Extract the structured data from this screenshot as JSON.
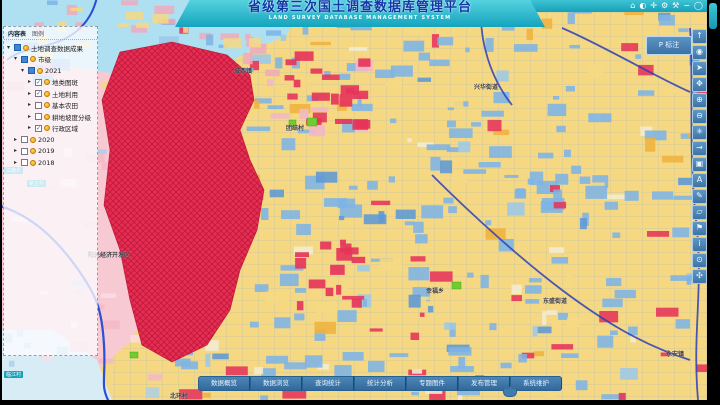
{
  "header": {
    "title": "省级第三次国土调查数据库管理平台",
    "subtitle": "LAND SURVEY DATABASE MANAGEMENT SYSTEM",
    "window_icons": [
      {
        "name": "home-icon",
        "glyph": "⌂"
      },
      {
        "name": "globe-icon",
        "glyph": "◐"
      },
      {
        "name": "locate-icon",
        "glyph": "✛"
      },
      {
        "name": "settings-gear-icon",
        "glyph": "⚙"
      },
      {
        "name": "tools-icon",
        "glyph": "⚒"
      },
      {
        "name": "minimize-icon",
        "glyph": "−"
      },
      {
        "name": "about-icon",
        "glyph": "◯"
      }
    ]
  },
  "annotate_button": {
    "label": "P 标注"
  },
  "layer_panel": {
    "tabs": [
      {
        "label": "内容表",
        "active": true
      },
      {
        "label": "图例",
        "active": false
      }
    ],
    "tree": [
      {
        "indent": 0,
        "expanded": true,
        "checkbox": null,
        "icons": [
          "bsq",
          "odot"
        ],
        "label": "土地调查数据成果"
      },
      {
        "indent": 1,
        "expanded": true,
        "checkbox": null,
        "icons": [
          "bsq",
          "odot"
        ],
        "label": "市级"
      },
      {
        "indent": 2,
        "expanded": true,
        "checkbox": null,
        "icons": [
          "bsq",
          "odot"
        ],
        "label": "2021"
      },
      {
        "indent": 3,
        "expanded": false,
        "checkbox": true,
        "icons": [
          "odot"
        ],
        "label": "地类图斑"
      },
      {
        "indent": 3,
        "expanded": false,
        "checkbox": true,
        "icons": [
          "odot"
        ],
        "label": "土地利用"
      },
      {
        "indent": 3,
        "expanded": false,
        "checkbox": false,
        "icons": [
          "odot"
        ],
        "label": "基本农田"
      },
      {
        "indent": 3,
        "expanded": false,
        "checkbox": false,
        "icons": [
          "odot"
        ],
        "label": "耕地坡度分级"
      },
      {
        "indent": 3,
        "expanded": false,
        "checkbox": true,
        "icons": [
          "odot"
        ],
        "label": "行政区域"
      },
      {
        "indent": 1,
        "expanded": false,
        "checkbox": false,
        "icons": [
          "odot"
        ],
        "label": "2020"
      },
      {
        "indent": 1,
        "expanded": false,
        "checkbox": false,
        "icons": [
          "odot"
        ],
        "label": "2019"
      },
      {
        "indent": 1,
        "expanded": false,
        "checkbox": false,
        "icons": [
          "odot"
        ],
        "label": "2018"
      }
    ]
  },
  "right_toolbar": {
    "buttons": [
      {
        "name": "pan-up-icon",
        "glyph": "↑"
      },
      {
        "name": "full-extent-icon",
        "glyph": "◉"
      },
      {
        "name": "select-cursor-icon",
        "glyph": "➤"
      },
      {
        "name": "pan-hand-icon",
        "glyph": "✥"
      },
      {
        "name": "zoom-in-icon",
        "glyph": "⊕"
      },
      {
        "name": "zoom-out-icon",
        "glyph": "⊖"
      },
      {
        "name": "previous-extent-icon",
        "glyph": "✳"
      },
      {
        "name": "next-extent-icon",
        "glyph": "→"
      },
      {
        "name": "identify-icon",
        "glyph": "▣"
      },
      {
        "name": "label-icon",
        "glyph": "A"
      },
      {
        "name": "sketch-pencil-icon",
        "glyph": "✎"
      },
      {
        "name": "edit-polygon-icon",
        "glyph": "▱"
      },
      {
        "name": "flag-icon",
        "glyph": "⚑"
      },
      {
        "name": "info-icon",
        "glyph": "i"
      },
      {
        "name": "query-icon",
        "glyph": "⊙"
      },
      {
        "name": "share-network-icon",
        "glyph": "✣"
      }
    ]
  },
  "bottom_toolbar": {
    "buttons": [
      {
        "label": "数据概览"
      },
      {
        "label": "数据浏览"
      },
      {
        "label": "查询统计"
      },
      {
        "label": "统计分析"
      },
      {
        "label": "专题图件"
      },
      {
        "label": "发布管理"
      },
      {
        "label": "系统维护"
      }
    ],
    "collapse_glyph": "ˇ"
  },
  "map": {
    "labels": [
      {
        "text": "城西镇",
        "x": 232,
        "y": 66,
        "style": "dark"
      },
      {
        "text": "兴华街道",
        "x": 472,
        "y": 82,
        "style": "dark"
      },
      {
        "text": "团结村",
        "x": 284,
        "y": 123,
        "style": "dark"
      },
      {
        "text": "阳光经济开发区",
        "x": 86,
        "y": 250,
        "style": "dark"
      },
      {
        "text": "幸福乡",
        "x": 424,
        "y": 286,
        "style": "dark"
      },
      {
        "text": "东盛街道",
        "x": 541,
        "y": 296,
        "style": "dark"
      },
      {
        "text": "永安镇",
        "x": 664,
        "y": 349,
        "style": "dark"
      },
      {
        "text": "北环村",
        "x": 168,
        "y": 391,
        "style": "dark"
      },
      {
        "text": "绕城高速",
        "x": 186,
        "y": 4,
        "style": "gray-tag"
      },
      {
        "text": "江南乡",
        "x": 2,
        "y": 167,
        "style": "teal-tag"
      },
      {
        "text": "新立村",
        "x": 25,
        "y": 180,
        "style": "teal-tag"
      },
      {
        "text": "临江村",
        "x": 2,
        "y": 371,
        "style": "teal-tag"
      }
    ],
    "colors": {
      "parcel_yellow": "#f6d883",
      "parcel_blue": "#7db3e6",
      "parcel_red": "#e6335a",
      "urban_red": "#e62e52",
      "region_pink": "#f7c9d2",
      "water_blue": "#aee0f2",
      "river_blue": "#2b50d4",
      "boundary_blue": "#2b3fb8",
      "header_teal": "#1ba6bc"
    }
  }
}
